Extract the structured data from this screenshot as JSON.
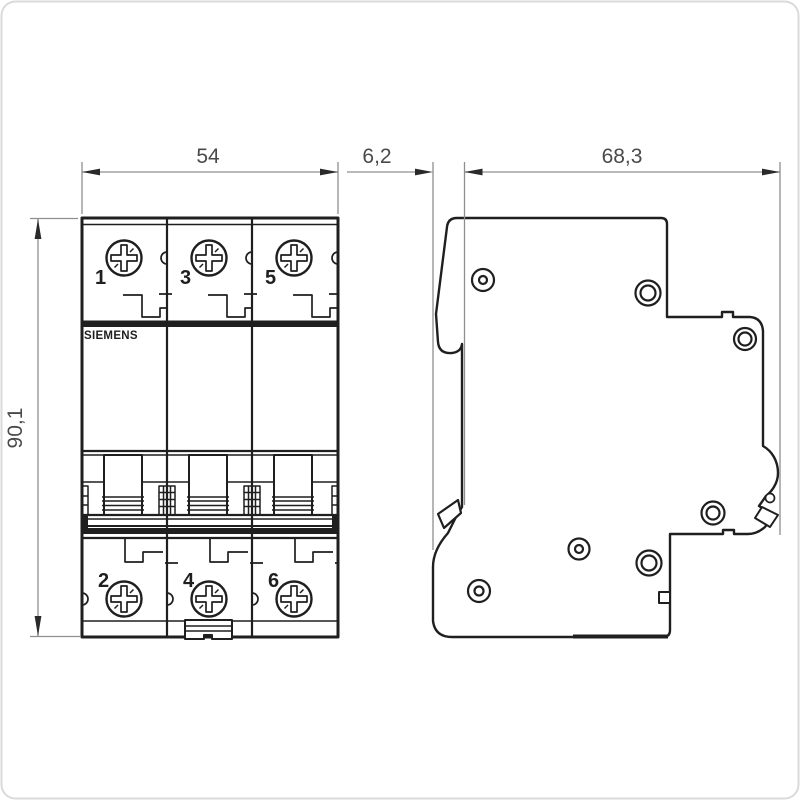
{
  "drawing": {
    "title_hint": "circuit-breaker dimension drawing",
    "brand_label": "SIEMENS",
    "dimensions": {
      "front_width": "54",
      "front_height": "90,1",
      "side_rail_depth": "6,2",
      "side_total_depth": "68,3"
    },
    "front_view": {
      "top_terminals": [
        "1",
        "3",
        "5"
      ],
      "bottom_terminals": [
        "2",
        "4",
        "6"
      ]
    },
    "colors": {
      "line": "#1f1f1f",
      "dimension_line": "#8f8f8f",
      "dimension_text": "#4a4a4a",
      "background": "#ffffff",
      "frame": "#dadada"
    }
  }
}
